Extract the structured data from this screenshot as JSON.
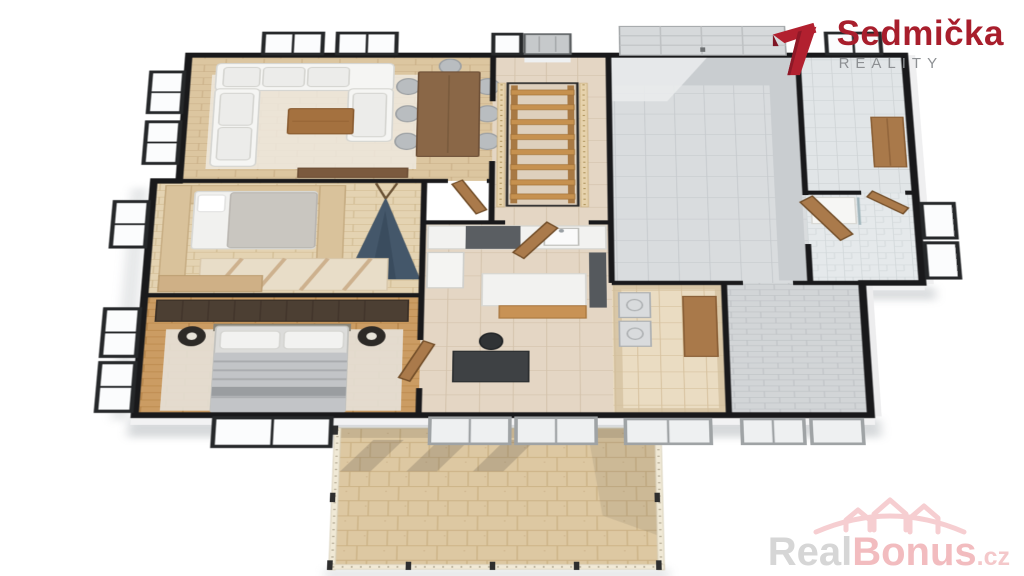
{
  "branding": {
    "name": "Sedmička",
    "tagline": "REALITY",
    "accent_red": "#b2202f",
    "tagline_gray": "#8d9093"
  },
  "watermark": {
    "part_gray": "Real",
    "part_pink": "Bonus",
    "suffix": ".cz",
    "pink": "#f2bcbf",
    "gray": "#d6d6d6"
  },
  "scene": {
    "description_colors": {
      "background": "#ffffff",
      "walls": "#19191b",
      "living_wood_floor": "#dcc6a0",
      "bedroom_oak_floor": "#cb9c63",
      "hall_tile": "#e4d6c4",
      "garage_tile": "#d9dcde",
      "terrace_stone": "#ddc8a2",
      "sofa_white": "#f5f5f3",
      "teepee_blue": "#44576a",
      "door_wood": "#aa7a4b",
      "window_frame": "#26282a"
    }
  }
}
